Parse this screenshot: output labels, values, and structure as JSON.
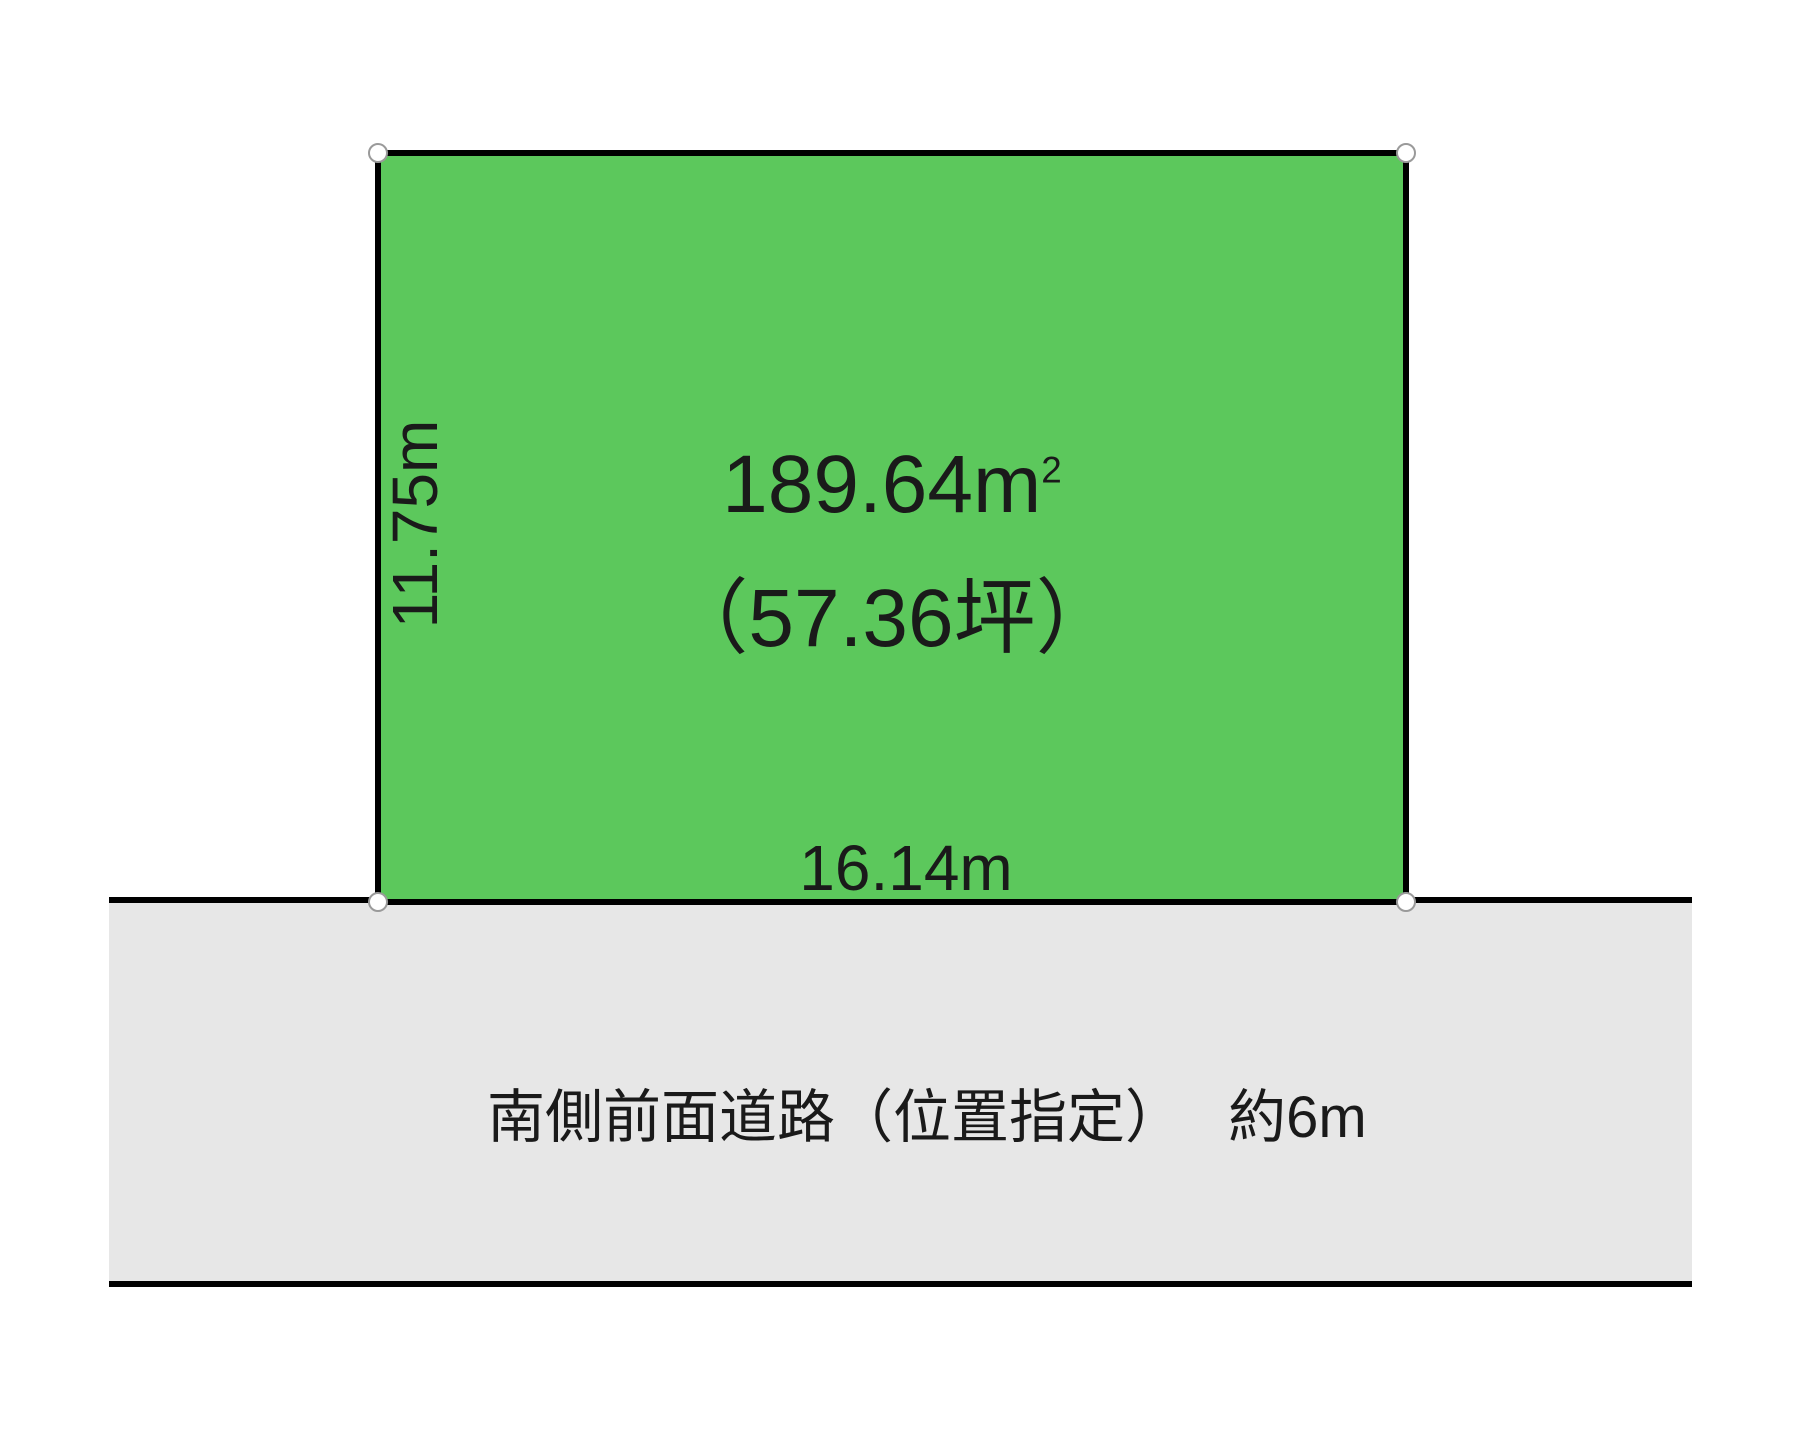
{
  "plot": {
    "area_label": "189.64m",
    "area_sup": "2",
    "tsubo_label": "（57.36坪）",
    "width_label": "16.14m",
    "side_label": "11.75m"
  },
  "road": {
    "label": "南側前面道路（位置指定）　 約6m"
  },
  "colors": {
    "plot_fill": "#5cc85c",
    "road_fill": "#e7e7e7",
    "border": "#000000",
    "marker_fill": "#ffffff",
    "marker_stroke": "#9a9a9a",
    "text": "#1a1a1a"
  }
}
